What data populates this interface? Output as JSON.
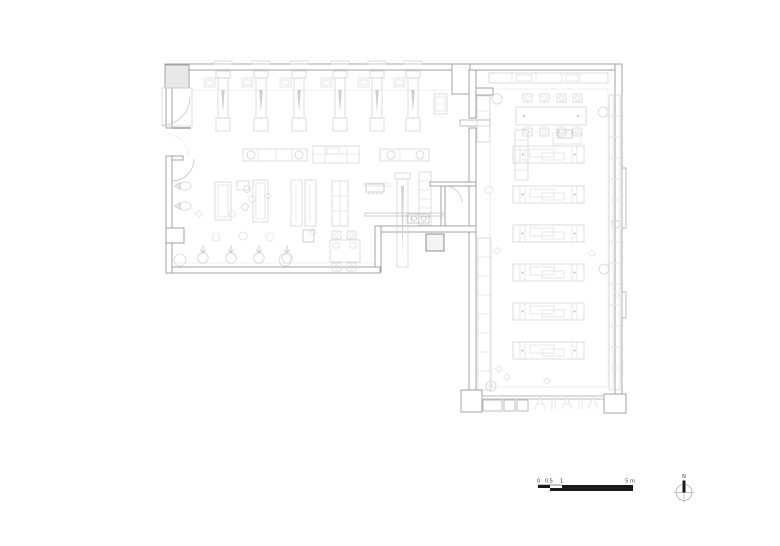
{
  "scale_bar": {
    "tick_zero": "0",
    "tick_half": "0.5",
    "tick_one": "1",
    "tick_five": "5 m"
  },
  "north_arrow": {
    "label": "N"
  },
  "colors": {
    "background": "#ffffff",
    "wall_line": "#a3a3a3",
    "furniture_line": "#d4d4d4",
    "dark_accent": "#1a1a1a"
  },
  "plan_summary": {
    "wings": 2,
    "top_rack_units": 6,
    "workbench_rows": 6,
    "dining_chairs": 8,
    "floor_plants": 4
  }
}
